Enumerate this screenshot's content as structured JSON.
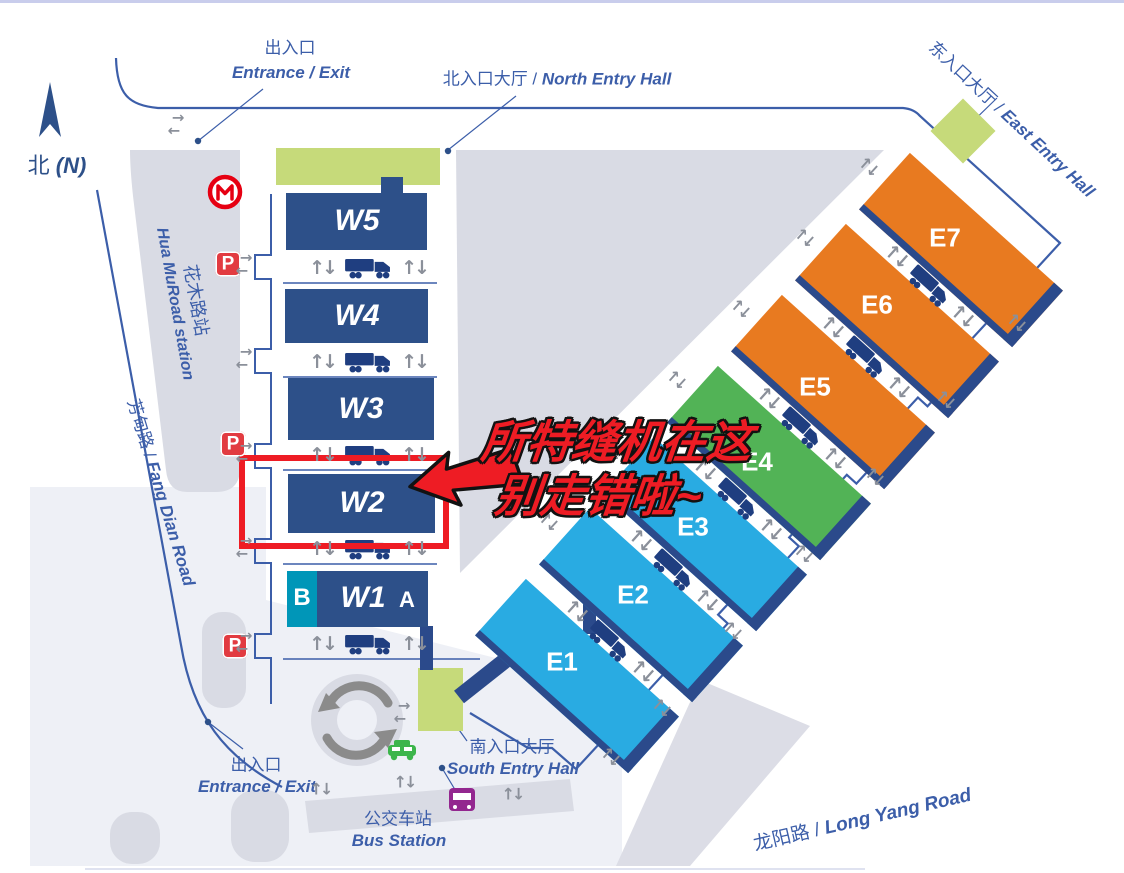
{
  "red_annotation": {
    "line1": "所特缝机在这",
    "line2": "别走错啦~"
  },
  "compass": {
    "zh": "北",
    "en": "(N)"
  },
  "roads": {
    "fang_dian_zh": "芳甸路 /",
    "fang_dian_en": "Fang Dian Road",
    "long_yang_zh": "龙阳路 /",
    "long_yang_en": "Long Yang Road"
  },
  "entrances": {
    "top": {
      "zh": "出入口",
      "en": "Entrance / Exit"
    },
    "bottom": {
      "zh": "出入口",
      "en": "Entrance / Exit"
    },
    "north": {
      "zh": "北入口大厅 /",
      "en": "North Entry Hall"
    },
    "east": {
      "zh": "东入口大厅 /",
      "en": "East Entry Hall"
    },
    "south": {
      "zh": "南入口大厅",
      "en": "South Entry Hall"
    }
  },
  "transit": {
    "metro": {
      "zh": "花木路站",
      "en": "Hua MuRoad station"
    },
    "bus": {
      "zh": "公交车站",
      "en": "Bus Station"
    }
  },
  "halls": {
    "west": [
      {
        "label": "W5"
      },
      {
        "label": "W4"
      },
      {
        "label": "W3"
      },
      {
        "label": "W2"
      },
      {
        "label": "W1"
      }
    ],
    "east": [
      {
        "label": "E1"
      },
      {
        "label": "E2"
      },
      {
        "label": "E3"
      },
      {
        "label": "E4"
      },
      {
        "label": "E5"
      },
      {
        "label": "E6"
      },
      {
        "label": "E7"
      }
    ],
    "w1_sections": {
      "left": "B",
      "right": "A"
    },
    "highlighted": "W2"
  },
  "icons": {
    "parking": "P",
    "up_down": "↑↓",
    "right": "→",
    "left": "←"
  },
  "colors": {
    "hall_blue": "#2d5089",
    "teal": "#0096b8",
    "cyan": "#29abe2",
    "green": "#52b356",
    "orange": "#e87a20",
    "entry_green": "#c6da7a",
    "red": "#ee1c24",
    "label_blue": "#3c5ea9",
    "stripe_blue": "#2b4a8b"
  }
}
